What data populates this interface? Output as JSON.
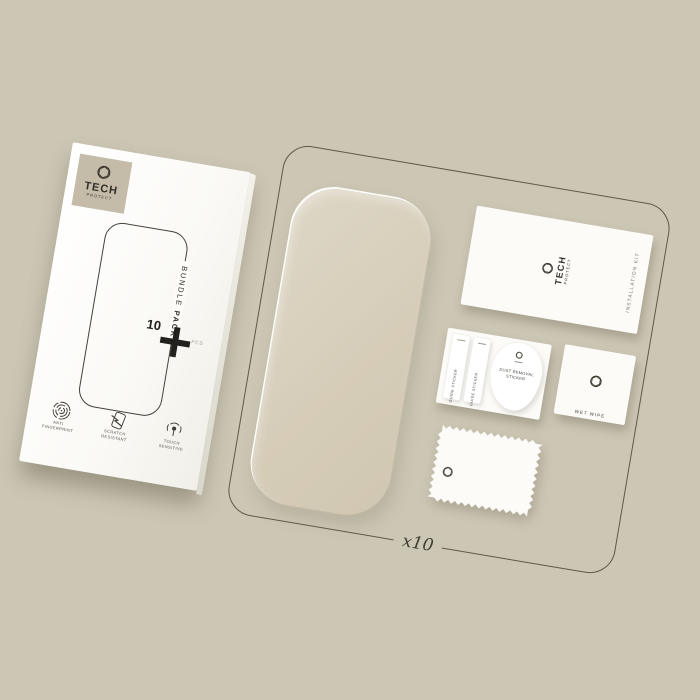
{
  "box": {
    "brand": {
      "name_top": "TECH",
      "name_bottom": "PROTECT"
    },
    "side_label_light": "BUNDLE",
    "side_label_bold": "PACK",
    "quantity": "10",
    "unit": "PCS",
    "features": [
      {
        "line1": "ANTI",
        "line2": "FINGERPRINT"
      },
      {
        "line1": "SCRATCH",
        "line2": "RESISTANT"
      },
      {
        "line1": "TOUCH",
        "line2": "SENSITIVE"
      }
    ]
  },
  "kit": {
    "multiplier_label": "x10",
    "card": {
      "brand_top": "TECH",
      "brand_bottom": "PROTECT",
      "side_label": "INSTALLATION KIT"
    },
    "stickers": {
      "guide_label": "GUIDE STICKER",
      "dust_line1": "DUST REMOVAL",
      "dust_line2": "STICKER"
    },
    "wet_wipe_label": "WET WIPE"
  },
  "colors": {
    "background": "#ccc6b4",
    "outline_stroke": "#5e584a",
    "box_white": "#fcfbf8",
    "logo_square": "#c4bba8",
    "glass_tint": "#d6cdb9",
    "text_dark": "#35332c"
  }
}
